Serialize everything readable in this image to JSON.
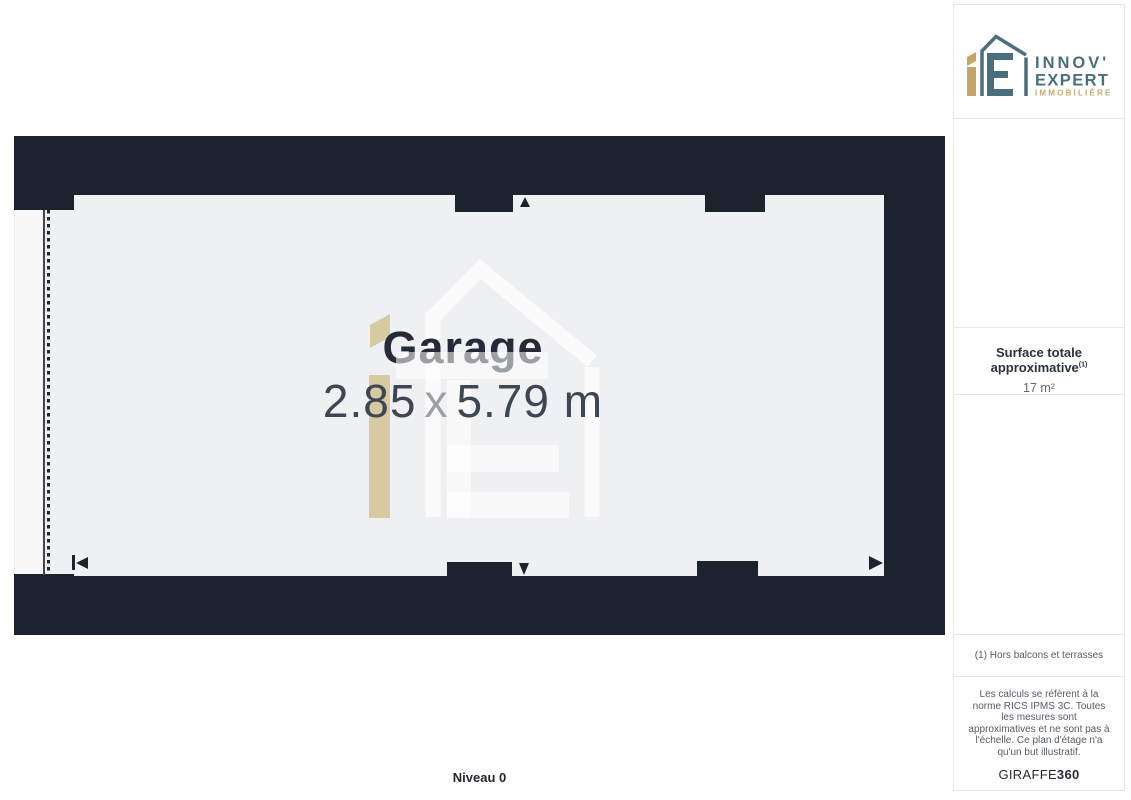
{
  "plan": {
    "room": {
      "name": "Garage",
      "width_m": "2.85",
      "separator": "x",
      "length_m": "5.79 m"
    },
    "level_label": "Niveau 0"
  },
  "sidebar": {
    "logo": {
      "line1": "INNOV'",
      "line2": "EXPERT",
      "line3": "IMMOBILIÈRE"
    },
    "surface": {
      "label": "Surface totale approximative",
      "footnote_marker": "(1)",
      "value": "17 m²"
    },
    "footnote": "(1) Hors balcons et terrasses",
    "disclaimer": "Les calculs se réfèrent à la norme RICS IPMS 3C. Toutes les mesures sont approximatives et ne sont pas à l'échelle. Ce plan d'étage n'a qu'un but illustratif.",
    "watermark_brand": {
      "name": "GIRAFFE",
      "suffix": "360"
    }
  },
  "colors": {
    "wall": "#1d232e",
    "floor": "#eff0f2",
    "gold": "#c7aa6d",
    "slate": "#4a6e7e",
    "text_dark": "#242a37"
  }
}
